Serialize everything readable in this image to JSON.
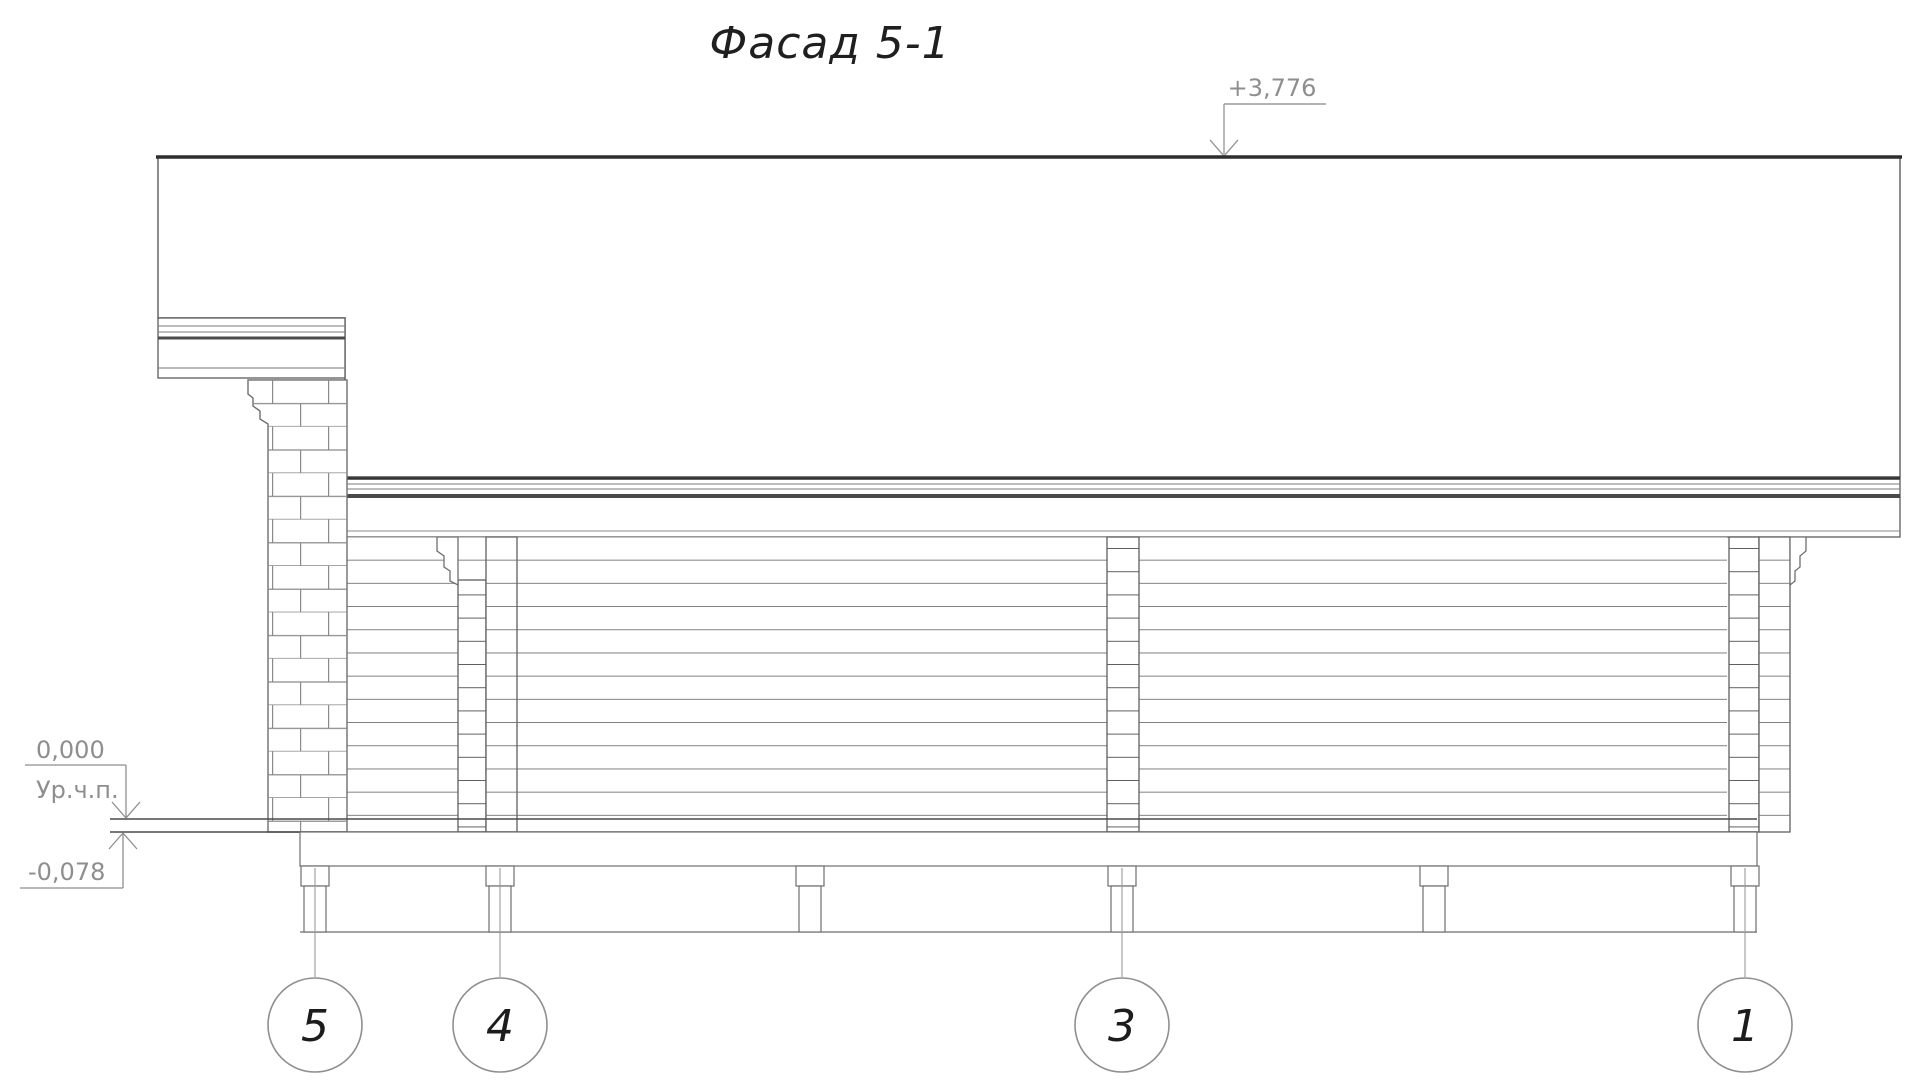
{
  "title": "Фасад 5-1",
  "marks": {
    "roof_elevation": "+3,776",
    "floor_elevation": "0,000",
    "floor_label": "Ур.ч.п.",
    "base_elevation": "-0,078"
  },
  "axes": {
    "bubbles": [
      "5",
      "4",
      "3",
      "1"
    ]
  },
  "colors": {
    "line_main": "#6e6e6e",
    "line_light": "#9b9b9b",
    "line_dark": "#2e2e2e",
    "annotation_gray": "#8e8e8e"
  }
}
